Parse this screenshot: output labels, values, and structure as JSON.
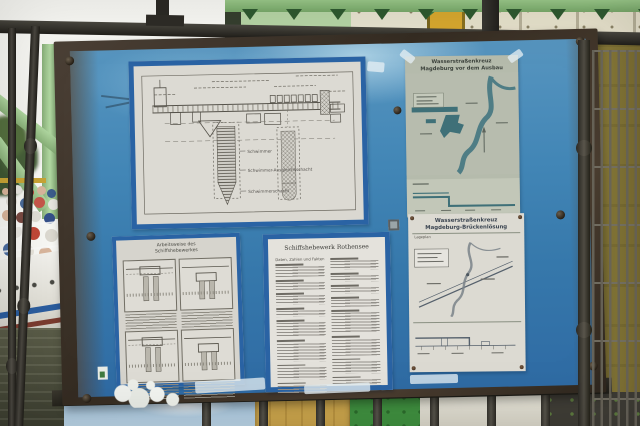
{
  "board": {
    "poster_cross_section": {
      "labels": {
        "schwimmer": "Schwimmer",
        "ausgleich": "Schwimmer-Ausgleichsschacht",
        "schacht": "Schwimmerschacht"
      }
    },
    "poster_map_old": {
      "title_line1": "Wasserstraßenkreuz",
      "title_line2": "Magdeburg vor dem Ausbau"
    },
    "poster_phases": {
      "title_line1": "Arbeitsweise des",
      "title_line2": "Schiffshebewerkes"
    },
    "poster_facts": {
      "title": "Schiffshebewerk Rothensee",
      "column_header": "Daten, Zahlen und Fakten"
    },
    "poster_bridge": {
      "title_line1": "Wasserstraßenkreuz",
      "title_line2": "Magdeburg-Brückenlösung",
      "map_label": "Lageplan"
    }
  },
  "colors": {
    "board_blue": "#3f85b5",
    "board_blue_dark": "#2f6ba4",
    "frame_rust": "#41362a",
    "poster_tape_blue": "#2a63a4",
    "paper": "#d9d7d0",
    "map_water_teal": "#4f7d85",
    "steel_green_light": "#a6d097",
    "girder_green": "#8cc07e",
    "column_yellow": "#d9a92f",
    "wall_olive": "#847637",
    "fence_iron": "#3a3833"
  }
}
